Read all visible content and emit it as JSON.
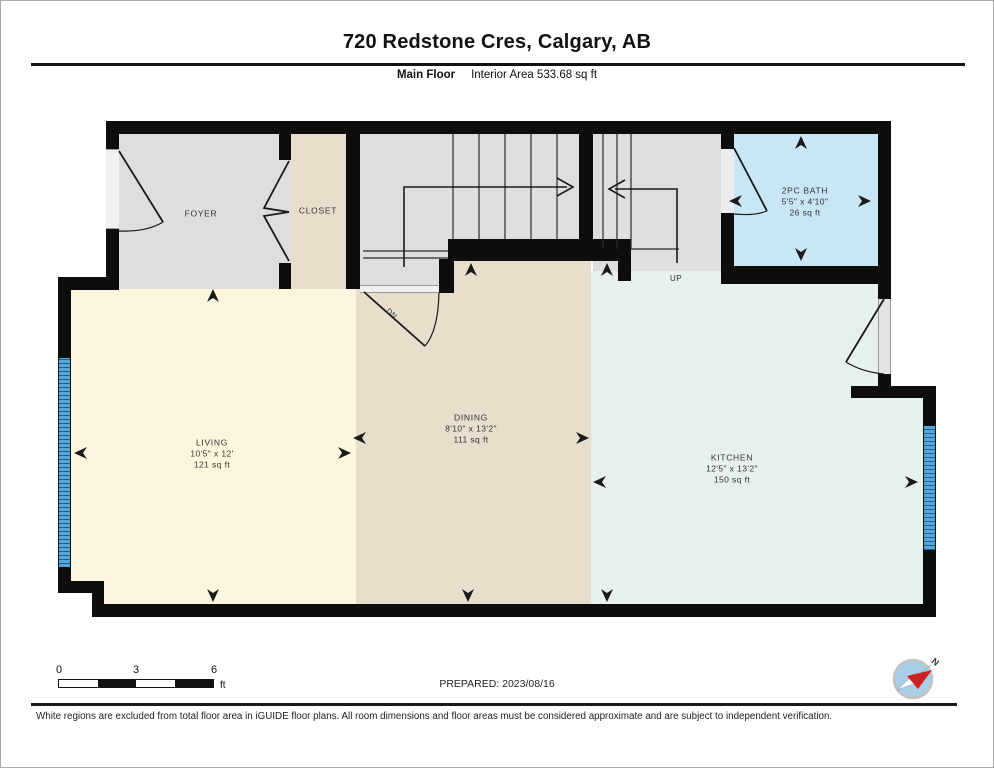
{
  "header": {
    "title": "720 Redstone Cres, Calgary, AB",
    "floor_label": "Main Floor",
    "area_label": "Interior Area 533.68 sq ft"
  },
  "rooms": {
    "foyer": {
      "name": "FOYER"
    },
    "closet": {
      "name": "CLOSET"
    },
    "bath": {
      "name": "2PC BATH",
      "dims": "5'5\" x 4'10\"",
      "area": "26 sq ft"
    },
    "living": {
      "name": "LIVING",
      "dims": "10'5\" x 12'",
      "area": "121 sq ft"
    },
    "dining": {
      "name": "DINING",
      "dims": "8'10\" x 13'2\"",
      "area": "111 sq ft"
    },
    "kitchen": {
      "name": "KITCHEN",
      "dims": "12'5\" x 13'2\"",
      "area": "150 sq ft"
    }
  },
  "stairs": {
    "up_label": "UP",
    "down_label": "DN"
  },
  "scale_bar": {
    "tick0": "0",
    "tick3": "3",
    "tick6": "6",
    "unit": "ft"
  },
  "prepared_label": "PREPARED: 2023/08/16",
  "compass": {
    "north_label": "N"
  },
  "footer_note": "White regions are excluded from total floor area in iGUIDE floor plans. All room dimensions and floor areas must be considered approximate and are subject to independent verification.",
  "colors": {
    "wall": "#0d0d0d",
    "foyer_stairs": "#dedede",
    "closet_dining": "#e8decb",
    "living": "#fbf6dd",
    "kitchen": "#e7f0ea",
    "bath": "#c9e6f6",
    "window": "#55a7da",
    "compass_north": "#cc2222"
  }
}
